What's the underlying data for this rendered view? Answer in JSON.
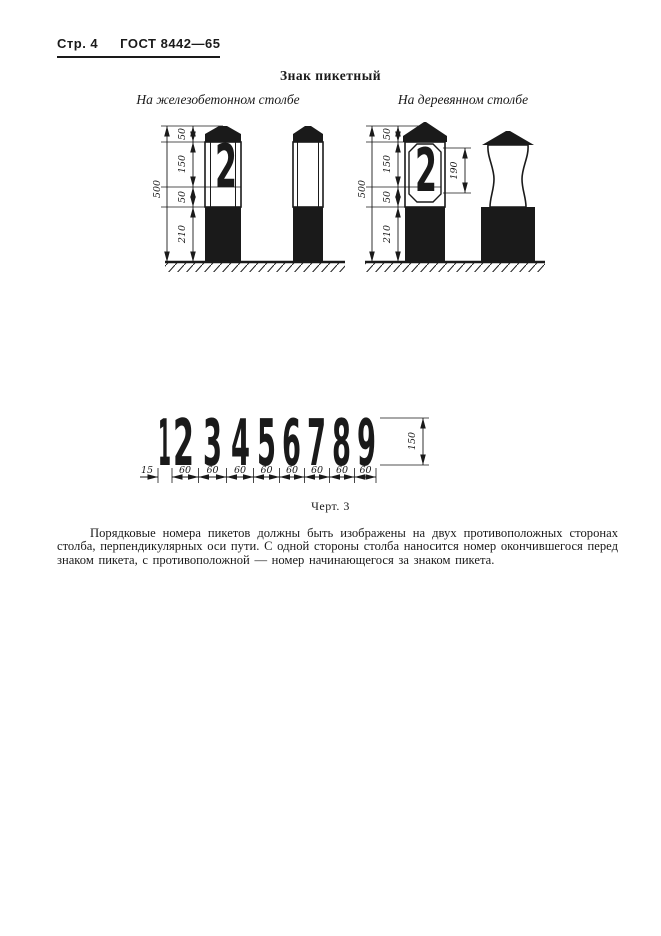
{
  "header": {
    "page_label": "Стр. 4",
    "doc_number": "ГОСТ 8442—65"
  },
  "figure": {
    "title": "Знак пикетный",
    "concrete_label": "На железобетонном столбе",
    "wood_label": "На деревянном столбе",
    "post_number": "2",
    "caption": "Черт. 3",
    "dims": {
      "total": "500",
      "cap": "50",
      "plate": "150",
      "gap": "50",
      "base": "210",
      "board": "190"
    },
    "digits_chart": {
      "digits": [
        "1",
        "2",
        "3",
        "4",
        "5",
        "6",
        "7",
        "8",
        "9"
      ],
      "one_width": "15",
      "digit_width": "60",
      "digit_height": "150"
    }
  },
  "paragraph": "Порядковые номера пикетов должны быть изображены на двух противоположных сторонах столба, перпендикулярных оси пути. С одной стороны столба наносится номер окончившегося перед знаком пикета, с противоположной — номер начинающегося за знаком пикета."
}
